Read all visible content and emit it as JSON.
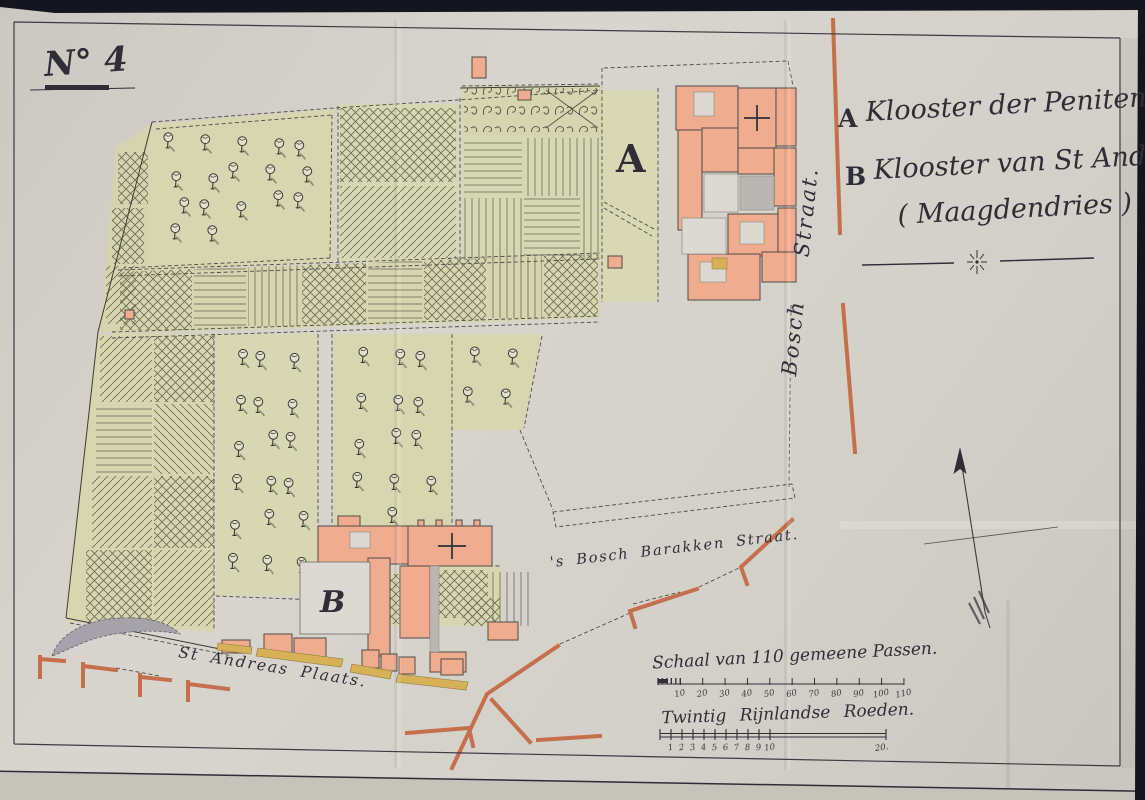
{
  "title": {
    "number": "N° 4"
  },
  "legend": {
    "entries": [
      {
        "key": "A",
        "label": "Klooster der Penitenten"
      },
      {
        "key": "B",
        "label": "Klooster van St Andries."
      }
    ],
    "subtitle": "( Maagdendries )"
  },
  "map_labels": {
    "marker_a": "A",
    "marker_b": "B",
    "bosch_straat": "Bosch Straat.",
    "barakken_straat": "'s Bosch Barakken Straat.",
    "andreas_plaats": "St Andreas Plaats."
  },
  "scale_bars": [
    {
      "title": "Schaal van 110 gemeene Passen.",
      "tick_labels": [
        "10",
        "20",
        "30",
        "40",
        "50",
        "60",
        "70",
        "80",
        "90",
        "100",
        "110"
      ]
    },
    {
      "title": "Twintig Rijnlandse Roeden.",
      "tick_labels": [
        "1",
        "2",
        "3",
        "4",
        "5",
        "6",
        "7",
        "8",
        "9",
        "10",
        "20."
      ]
    }
  ],
  "colors": {
    "paper": "#d4d1ca",
    "ink": "#2f2e37",
    "building_fill": "#efac8f",
    "street_line": "#c4704e",
    "garden_green": "#d7d6b1",
    "sidewalk_yellow": "#d6b158",
    "courtyard_white": "#dcd9d2",
    "shading_gray": "#b9b6b4",
    "hatch": "#6a6a58"
  }
}
